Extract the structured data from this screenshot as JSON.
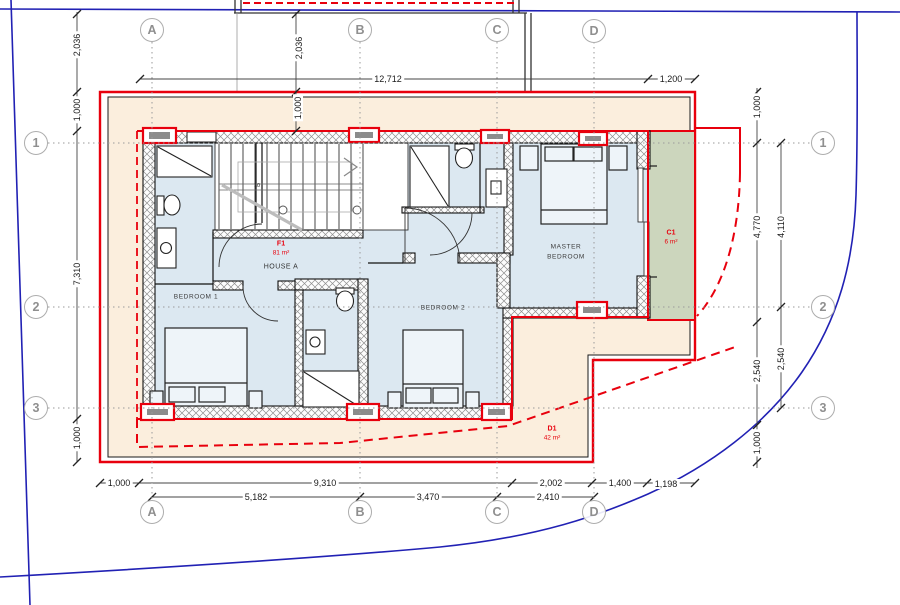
{
  "title": "First floor plan - House A",
  "colors": {
    "boundary_red": "#e8000d",
    "boundary_blue": "#2121b4",
    "plot_fill": "#fbeedd",
    "room_fill": "#dce8f1",
    "balcony_fill": "#ccd6bd",
    "dim_gray": "#444444"
  },
  "grid": {
    "columns": [
      "A",
      "B",
      "C",
      "D"
    ],
    "rows": [
      "1",
      "2",
      "3"
    ]
  },
  "rooms": {
    "bedroom1": "BEDROOM 1",
    "bedroom2": "BEDROOM 2",
    "master": "MASTER BEDROOM"
  },
  "units": {
    "f1": {
      "code": "F1",
      "area": "81 m²",
      "name": "HOUSE A"
    },
    "c1": {
      "code": "C1",
      "area": "6 m²"
    },
    "d1": {
      "code": "D1",
      "area": "42 m²"
    }
  },
  "stair": {
    "run_label": "10"
  },
  "dims": {
    "top_main": "12,712",
    "top_right": "1,200",
    "left_1": "2,036",
    "left_2": "1,000",
    "left_3": "7,310",
    "left_4": "1,000",
    "colb_1": "2,036",
    "colb_2": "1,000",
    "right_a1": "1,000",
    "right_a2": "4,770",
    "right_a3": "2,540",
    "right_a4": "1,000",
    "right_b1": "4,110",
    "right_b2": "2,540",
    "bottom1_1": "1,000",
    "bottom1_2": "9,310",
    "bottom1_3": "2,002",
    "bottom1_4": "1,400",
    "bottom1_5": "1,198",
    "bottom2_1": "5,182",
    "bottom2_2": "3,470",
    "bottom2_3": "2,410"
  }
}
